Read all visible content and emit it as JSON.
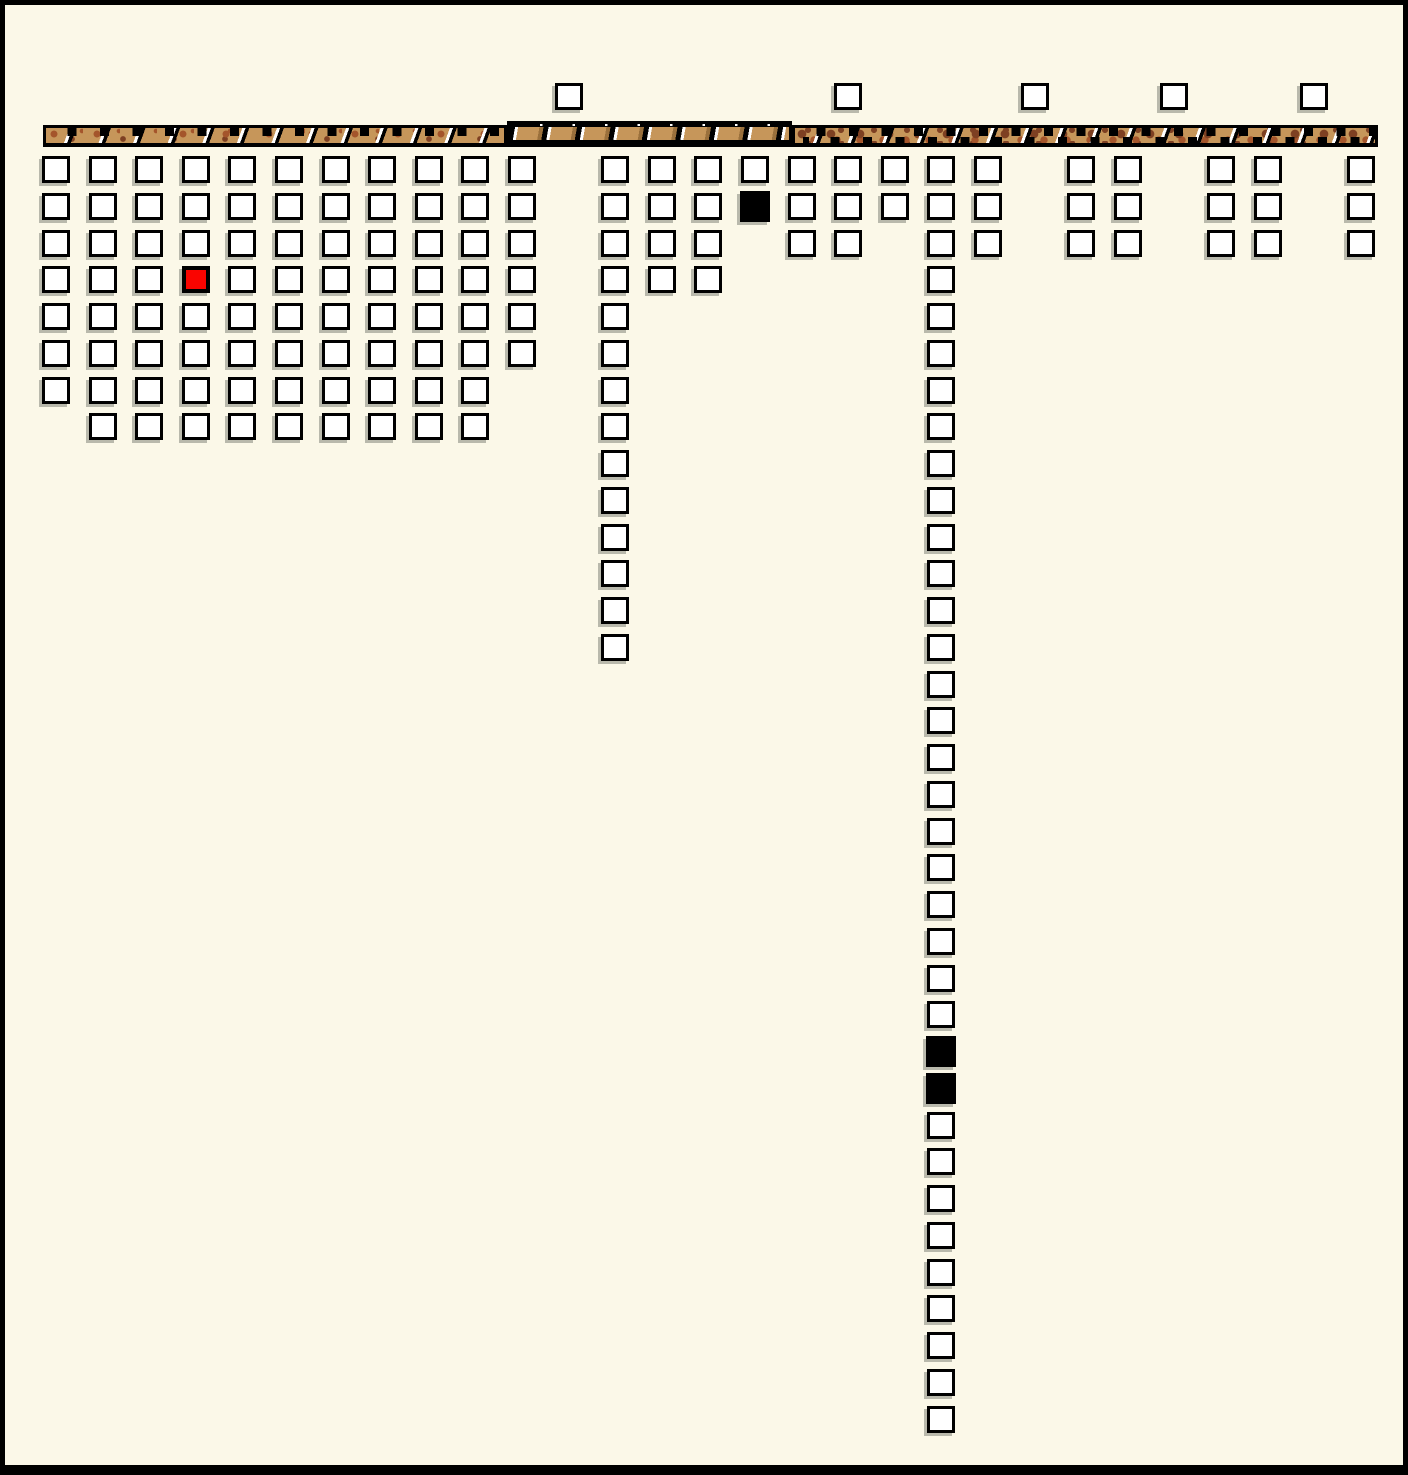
{
  "diagram": {
    "background_color": "#FBF8E8",
    "frame_color": "#000000",
    "beam": {
      "segments": [
        {
          "id": "left",
          "x": 38,
          "y": 120,
          "width": 464,
          "height": 22,
          "texture": "spotted-notched"
        },
        {
          "id": "middle",
          "x": 502,
          "y": 116,
          "width": 285,
          "height": 26,
          "texture": "plank-hatched"
        },
        {
          "id": "right",
          "x": 787,
          "y": 120,
          "width": 586,
          "height": 22,
          "texture": "leopard-hatched"
        }
      ],
      "colors": {
        "wood": "#C6965A",
        "spot_dark": "#7E4022",
        "spot_mid": "#A4552B",
        "hatch_white": "#FFFFFF",
        "hatch_black": "#000000"
      }
    },
    "grid": {
      "origin_x": 37,
      "origin_y": 151,
      "col_pitch": 46.6,
      "row_pitch": 36.75,
      "square_width": 28,
      "square_height": 27
    },
    "top_row": {
      "y": 78,
      "cols": [
        11,
        17,
        21,
        24,
        27
      ]
    },
    "stacks": [
      {
        "col": 0,
        "row_start": 0,
        "row_end": 6
      },
      {
        "col": 1,
        "row_start": 0,
        "row_end": 7
      },
      {
        "col": 2,
        "row_start": 0,
        "row_end": 7
      },
      {
        "col": 3,
        "row_start": 0,
        "row_end": 7
      },
      {
        "col": 4,
        "row_start": 0,
        "row_end": 7
      },
      {
        "col": 5,
        "row_start": 0,
        "row_end": 7
      },
      {
        "col": 6,
        "row_start": 0,
        "row_end": 7
      },
      {
        "col": 7,
        "row_start": 0,
        "row_end": 7
      },
      {
        "col": 8,
        "row_start": 0,
        "row_end": 7
      },
      {
        "col": 9,
        "row_start": 0,
        "row_end": 7
      },
      {
        "col": 10,
        "row_start": 0,
        "row_end": 5
      },
      {
        "col": 12,
        "row_start": 0,
        "row_end": 13
      },
      {
        "col": 13,
        "row_start": 0,
        "row_end": 3
      },
      {
        "col": 14,
        "row_start": 0,
        "row_end": 3
      },
      {
        "col": 15,
        "row_start": 0,
        "row_end": 1
      },
      {
        "col": 16,
        "row_start": 0,
        "row_end": 2
      },
      {
        "col": 17,
        "row_start": 0,
        "row_end": 2
      },
      {
        "col": 18,
        "row_start": 0,
        "row_end": 1
      },
      {
        "col": 19,
        "row_start": 0,
        "row_end": 34
      },
      {
        "col": 20,
        "row_start": 0,
        "row_end": 2
      },
      {
        "col": 22,
        "row_start": 0,
        "row_end": 2
      },
      {
        "col": 23,
        "row_start": 0,
        "row_end": 2
      },
      {
        "col": 25,
        "row_start": 0,
        "row_end": 2
      },
      {
        "col": 26,
        "row_start": 0,
        "row_end": 2
      },
      {
        "col": 28,
        "row_start": 0,
        "row_end": 2
      }
    ],
    "marked_squares": [
      {
        "col": 3,
        "row": 3,
        "state": "red"
      },
      {
        "col": 15,
        "row": 1,
        "state": "black"
      },
      {
        "col": 19,
        "row": 24,
        "state": "black"
      },
      {
        "col": 19,
        "row": 25,
        "state": "black"
      }
    ],
    "square_colors": {
      "fill": "#FFFFFF",
      "border": "#000000",
      "red": "#FA0400",
      "black": "#000000",
      "shadow": "#B9B9AC"
    },
    "counts": {
      "total_squares": 175,
      "above_beam_squares": 5,
      "red_squares": 1,
      "black_squares": 3
    }
  }
}
